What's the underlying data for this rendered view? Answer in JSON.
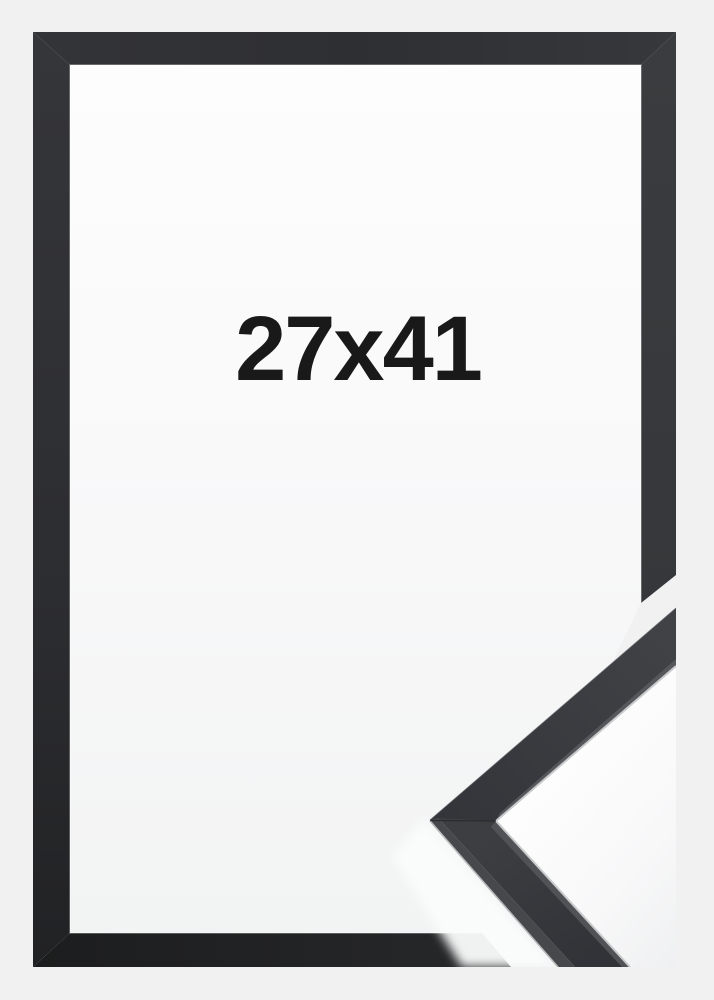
{
  "frame_photo": {
    "size_label": "27x41",
    "colors": {
      "page_background": "#f1f1f2",
      "frame_dark": "#323336",
      "frame_darkest": "#1d1e1f",
      "interior_white": "#fdfdfd",
      "molding_face": "#3a3c40",
      "molding_side_facet": "#46484b",
      "molding_highlight_edge": "#c9cacc",
      "label_text": "#19191a"
    }
  }
}
